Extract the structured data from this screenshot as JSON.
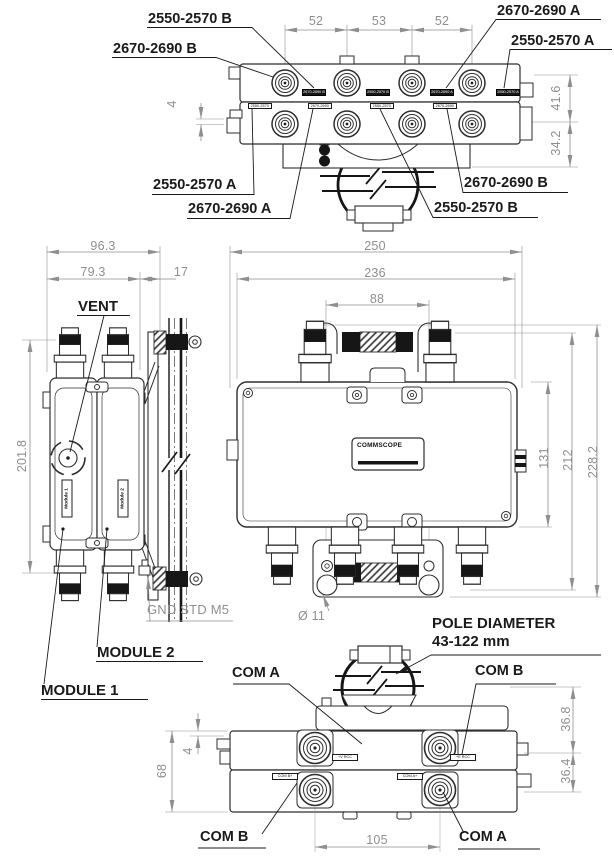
{
  "top_view": {
    "dim_52_left": "52",
    "dim_53": "53",
    "dim_52_right": "52",
    "dim_41_6": "41.6",
    "dim_34_2": "34.2",
    "dim_4": "4",
    "callout_top_1": "2550-2570 B",
    "callout_top_2": "2670-2690 B",
    "callout_top_3": "2670-2690 A",
    "callout_top_4": "2550-2570 A",
    "callout_bottom_1": "2550-2570 A",
    "callout_bottom_2": "2670-2690 A",
    "callout_bottom_3": "2670-2690 B",
    "callout_bottom_4": "2550-2570 B",
    "port_labels_row1": [
      "2670-2690 B",
      "2550-2570 B",
      "2670-2690 A",
      "2550-2570 A"
    ],
    "port_labels_row2": [
      "2550-2570 A",
      "2670-2690 A",
      "2550-2570 B",
      "2670-2690 B"
    ]
  },
  "side_view": {
    "dim_96_3": "96.3",
    "dim_79_3": "79.3",
    "dim_17": "17",
    "dim_201_8": "201.8",
    "vent": "VENT",
    "module_tag_1": "Module 1",
    "module_tag_2": "Module 2",
    "gnd": "GND STD M5",
    "callout_module_1": "MODULE 1",
    "callout_module_2": "MODULE 2"
  },
  "front_view": {
    "dim_250": "250",
    "dim_236": "236",
    "dim_88": "88",
    "dim_131": "131",
    "dim_212": "212",
    "dim_228_2": "228.2",
    "dim_hole": "Ø 11",
    "brand": "COMMSCOPE"
  },
  "bottom_view": {
    "pole_line1": "POLE DIAMETER",
    "pole_line2": "43-122 mm",
    "callout_com_tl": "COM A",
    "callout_com_tr": "COM B",
    "callout_com_bl": "COM B",
    "callout_com_br": "COM A",
    "port_label_t1": "+V RCC",
    "port_label_t2": "+E RCC",
    "port_label_b1": "COM B+",
    "port_label_b2": "COM A+",
    "dim_68": "68",
    "dim_4": "4",
    "dim_105": "105",
    "dim_36_8": "36.8",
    "dim_36_4": "36.4"
  }
}
